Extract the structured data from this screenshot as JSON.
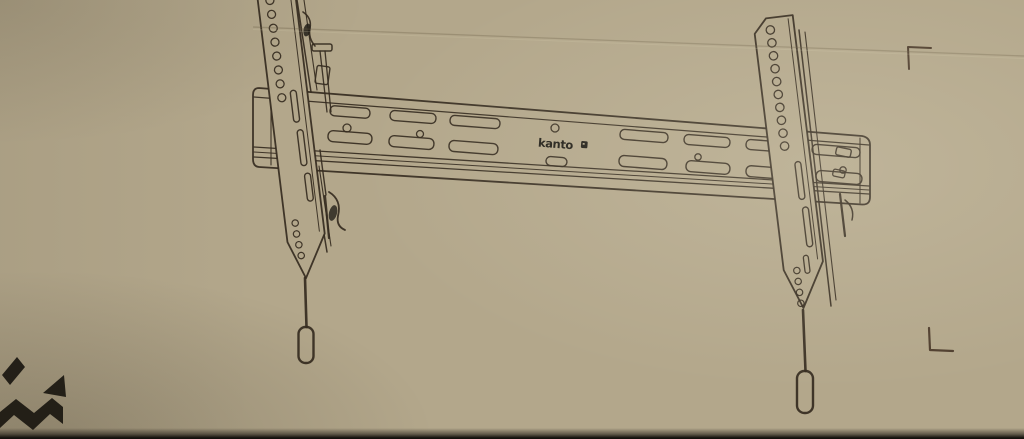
{
  "branding": {
    "wordmark": "kanto"
  },
  "artwork": {
    "subject": "Line illustration of a tilting TV wall mount printed on a cardboard box",
    "elements": [
      "horizontal wall plate rail with staggered mounting slots and holes",
      "left TV bracket with hole column, slots and tilt pull rod with handle",
      "right TV bracket with hole column, slots and tilt pull rod with handle",
      "crop mark top right",
      "crop mark bottom right",
      "kanto corner logo fragment bottom left"
    ]
  },
  "theme": {
    "cardboard": "#b3a78b",
    "line": "#352b1f",
    "ink": "#232019",
    "crease": "#6b5c44",
    "mark": "#4a3829",
    "photo_edge": "#14110d"
  }
}
